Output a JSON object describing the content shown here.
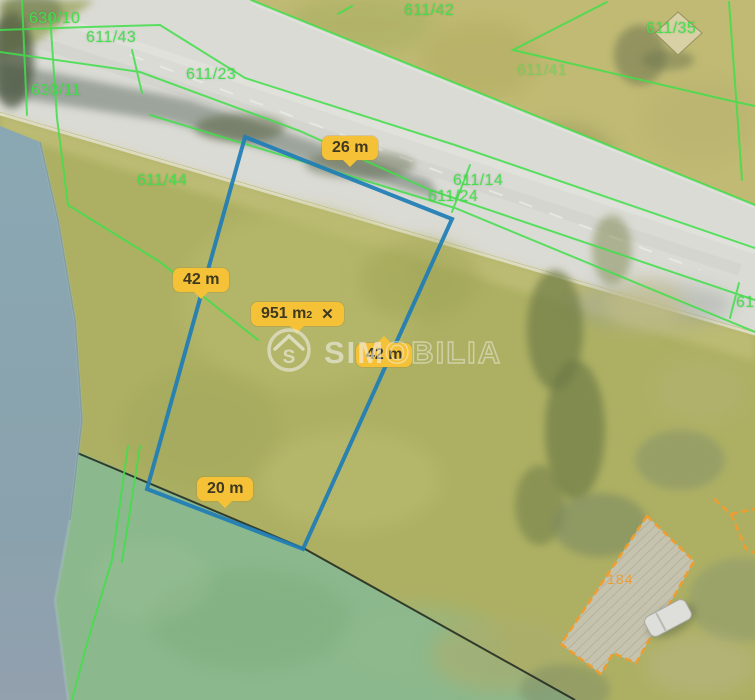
{
  "watermark": {
    "brand_bold": "SIM",
    "brand_light": "OBILIA",
    "logo": "house-s-logo"
  },
  "measurement": {
    "polygon_color": "#1e7db6",
    "label_bg": "#f5c237",
    "area": {
      "value": "951 m",
      "sup": "2",
      "close_icon": "✕"
    },
    "distances": [
      {
        "label": "26 m",
        "x": 322,
        "y": 136,
        "pointer": "bottom"
      },
      {
        "label": "42 m",
        "x": 173,
        "y": 268,
        "pointer": "bottom"
      },
      {
        "label": "42 m",
        "x": 356,
        "y": 343,
        "pointer": "top"
      },
      {
        "label": "20 m",
        "x": 197,
        "y": 477,
        "pointer": "bottom"
      }
    ]
  },
  "cadastre": {
    "line_color": "#42df4b",
    "parcels": [
      {
        "text": "630/10",
        "x": 29,
        "y": 10
      },
      {
        "text": "611/43",
        "x": 86,
        "y": 29
      },
      {
        "text": "611/23",
        "x": 186,
        "y": 66
      },
      {
        "text": "630/11",
        "x": 31,
        "y": 82
      },
      {
        "text": "611/44",
        "x": 137,
        "y": 172
      },
      {
        "text": "611/42",
        "x": 404,
        "y": 2
      },
      {
        "text": "611/41",
        "x": 517,
        "y": 62,
        "faint": true
      },
      {
        "text": "611/35",
        "x": 646,
        "y": 20
      },
      {
        "text": "611/14",
        "x": 453,
        "y": 172
      },
      {
        "text": "611/24",
        "x": 428,
        "y": 188
      },
      {
        "text": "61",
        "x": 736,
        "y": 294
      }
    ]
  },
  "buildings": {
    "outline_color": "#ef9d2f",
    "label": "184"
  }
}
